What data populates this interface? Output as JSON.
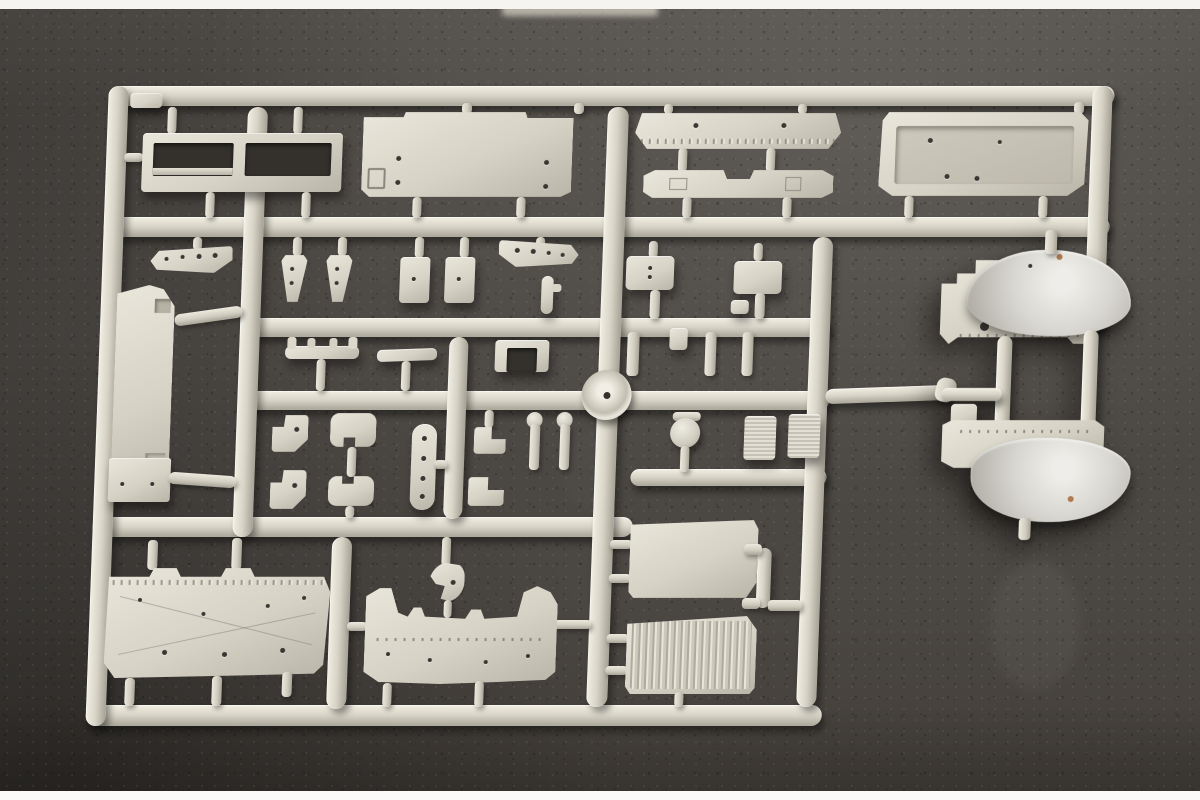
{
  "meta": {
    "type": "photograph",
    "subject": "Light-grey injection-molded plastic model kit sprue (parts tree) laid on dark flocked grey background, white letterbox strips at top and bottom",
    "text_visible": "none"
  },
  "palette": {
    "bg_base": "#4b4743",
    "bg_dark": "#37332f",
    "bg_light": "#5b5752",
    "plastic_light": "#edeade",
    "plastic_mid": "#d7d3c6",
    "plastic_dark": "#aba79a",
    "hole": "#3a3733",
    "copper": "#b07a4e",
    "strip_top": "#f5f4f0",
    "strip_bottom": "#fbfaf8"
  },
  "sprue": {
    "material": "light grey styrene",
    "layout": "rectangular runner frame with internal horizontal and vertical runners, centre circular hub boss, separate twin-fender cluster at right connected by a single runner",
    "approx_part_count": 40,
    "parts": [
      {
        "name": "windshield-frame",
        "desc": "open two-pane rectangular frame, top-left"
      },
      {
        "name": "cab-roof-panel",
        "desc": "large stepped panel with side block"
      },
      {
        "name": "front-bumper",
        "desc": "long tapered bar with rivet row"
      },
      {
        "name": "lower-valance-bar",
        "desc": "flat bar with centre notch"
      },
      {
        "name": "cab-rear-tray",
        "desc": "large panel with recessed tray interior"
      },
      {
        "name": "chassis-side-beam",
        "desc": "tall vertical slab with angled top and foot"
      },
      {
        "name": "perforated-bracket-left",
        "desc": "wedge bracket with holes"
      },
      {
        "name": "perforated-bracket-right",
        "desc": "mirrored wedge bracket with holes"
      },
      {
        "name": "wedge-clips",
        "desc": "two small triangular clips"
      },
      {
        "name": "mount-blocks",
        "desc": "two small rectangular blocks"
      },
      {
        "name": "equipment-boxes",
        "desc": "two rectangular boxes with dimples"
      },
      {
        "name": "grab-handle",
        "desc": "T-bar with upturned ends"
      },
      {
        "name": "linkage-blade",
        "desc": "thin flat bar"
      },
      {
        "name": "u-bracket",
        "desc": "channel bracket"
      },
      {
        "name": "pedal-hooks",
        "desc": "two hook/pedal pieces with holes"
      },
      {
        "name": "spring-seats",
        "desc": "two notched rounded blocks"
      },
      {
        "name": "perforated-strap",
        "desc": "vertical strip with four holes"
      },
      {
        "name": "step-angles",
        "desc": "two small L-steps"
      },
      {
        "name": "knob-pins",
        "desc": "two ball-headed pins"
      },
      {
        "name": "mirror-ball",
        "desc": "sphere on stem"
      },
      {
        "name": "knurled-boxes",
        "desc": "two textured rectangles"
      },
      {
        "name": "roof-deck-panel",
        "desc": "large bottom-left panel with rivet strip"
      },
      {
        "name": "crescent-hook",
        "desc": "comma-shaped hook with hole"
      },
      {
        "name": "cab-firewall-panel",
        "desc": "wide panel with twin horns and wavy top edge"
      },
      {
        "name": "radiator-grille-upper",
        "desc": "ribbed rectangular grille"
      },
      {
        "name": "radiator-grille-lower",
        "desc": "ribbed rectangular grille"
      },
      {
        "name": "fender-cluster",
        "desc": "separate piece: two domed fenders with flange plates and internal runners"
      },
      {
        "name": "hub-boss",
        "desc": "circular moulding boss at runner crossing"
      }
    ]
  }
}
